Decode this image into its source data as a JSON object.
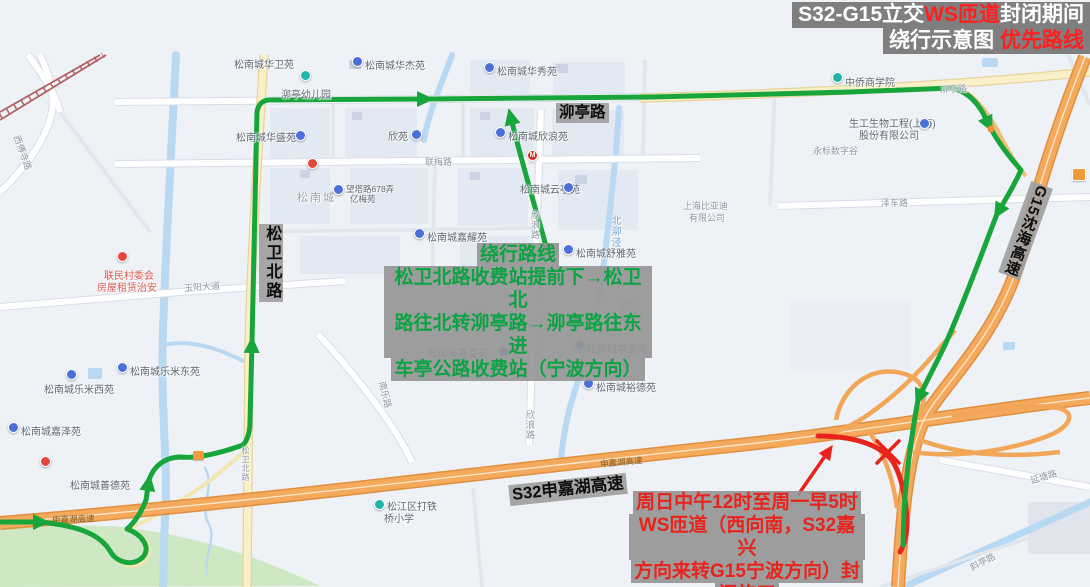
{
  "title": {
    "l1a": "S32-G15立交",
    "l1b": "WS匝道",
    "l1c": "封闭期间",
    "l2a": "绕行示意图 ",
    "l2b": "优先路线"
  },
  "detour": {
    "heading": "绕行路线",
    "l1": "松卫北路收费站提前下→松卫北",
    "l2": "路往北转泖亭路→泖亭路往东进",
    "l3": "车亭公路收费站（宁波方向）"
  },
  "closure": {
    "l1": "周日中午12时至周一早5时",
    "l2": "WS匝道（西向南，S32嘉兴",
    "l3": "方向来转G15宁波方向）封",
    "l4": "闭施工"
  },
  "big_roads": {
    "maoting": "泖亭路",
    "songwei": "松卫北路",
    "g15": "G15沈海高速",
    "s32": "S32申嘉湖高速"
  },
  "road_labels": {
    "lianmei": "联梅路",
    "yuyang": "玉阳大道",
    "xinlang1": "欣浪路",
    "xinlang2": "欣浪路",
    "beimaojing": "北泖泾",
    "nanle": "南乐路",
    "zeche": "泽车路",
    "yantang": "延塘路",
    "xieting": "斜亭路",
    "xifusi": "西傅寺路",
    "maoting_s": "泖亭路",
    "songwei_s": "松卫北路",
    "s32_a": "申嘉湖高速",
    "s32_b": "申嘉湖高速"
  },
  "pois": {
    "huawei": "松南城华卫苑",
    "huajie": "松南城华杰苑",
    "huaxiu": "松南城华秀苑",
    "maoting_kg": "泖亭幼儿园",
    "huasheng": "松南城华盛苑",
    "xinyuan": "欣苑",
    "xinlang": "松南城欣浪苑",
    "yunting": "松南城云亭苑",
    "byd1": "上海比亚迪",
    "byd2": "有限公司",
    "jiayao": "松南城嘉耀苑",
    "shuya": "松南城舒雅苑",
    "songnancheng": "松南城",
    "wangta1": "望塔路678弄",
    "wangta2": "亿梅苑",
    "lianmin1": "联民村委会",
    "lianmin2": "房屋租赁治安",
    "lemi_e": "松南城乐米东苑",
    "lemi_w": "松南城乐米西苑",
    "jiaze": "松南城嘉泽苑",
    "shande": "松南城善德苑",
    "school1": "松江区打铁",
    "school2": "桥小学",
    "shenggong1": "生工生物工程(上海)",
    "shenggong2": "股份有限公司",
    "yongbiao": "永标数字谷",
    "zhongqiao": "中侨商学院",
    "yurong": "松南城裕荣苑",
    "yude": "松南城裕德苑",
    "jiafu": "松南城嘉富苑",
    "mcd": "M"
  },
  "colors": {
    "route_green": "#17a53c",
    "route_red": "#e8231c",
    "highway_orange": "#f4a95c",
    "note_bg": "#969696",
    "title_bg": "#7f7f7f",
    "accent_red": "#ff1f1f",
    "water": "#b9d8f2"
  }
}
